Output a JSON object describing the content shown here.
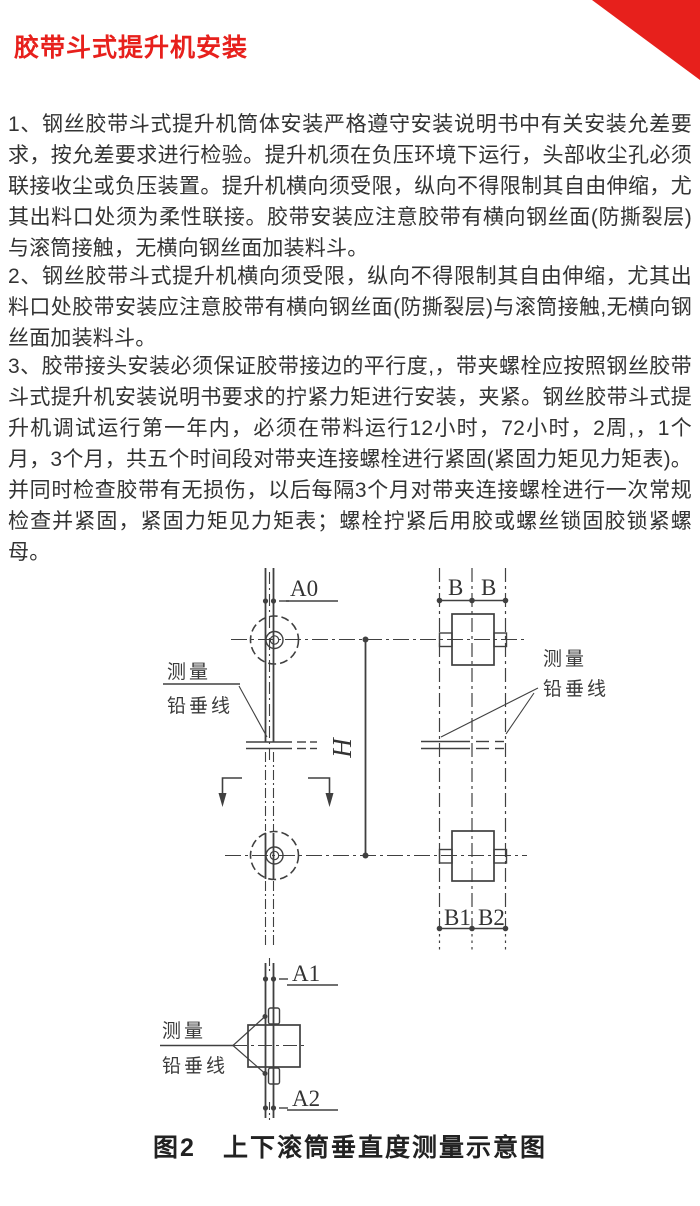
{
  "title": "胶带斗式提升机安装",
  "colors": {
    "accent": "#e7201c",
    "body_text": "#333333",
    "line": "#404040"
  },
  "paragraphs": {
    "p1": "1、钢丝胶带斗式提升机筒体安装严格遵守安装说明书中有关安装允差要求，按允差要求进行检验。提升机须在负压环境下运行，头部收尘孔必须联接收尘或负压装置。提升机横向须受限，纵向不得限制其自由伸缩，尤其出料口处须为柔性联接。胶带安装应注意胶带有横向钢丝面(防撕裂层)与滚筒接触，无横向钢丝面加装料斗。",
    "p2": "2、钢丝胶带斗式提升机横向须受限，纵向不得限制其自由伸缩，尤其出料口处胶带安装应注意胶带有横向钢丝面(防撕裂层)与滚筒接触,无横向钢丝面加装料斗。",
    "p3": "3、胶带接头安装必须保证胶带接边的平行度,，带夹螺栓应按照钢丝胶带斗式提升机安装说明书要求的拧紧力矩进行安装，夹紧。钢丝胶带斗式提升机调试运行第一年内，必须在带料运行12小时，72小时，2周,，1个月，3个月，共五个时间段对带夹连接螺栓进行紧固(紧固力矩见力矩表)。并同时检查胶带有无损伤，以后每隔3个月对带夹连接螺栓进行一次常规检查并紧固，紧固力矩见力矩表；螺栓拧紧后用胶或螺丝锁固胶锁紧螺母。"
  },
  "diagram": {
    "labels": {
      "a0": "A0",
      "a1": "A1",
      "a2": "A2",
      "b_left": "B",
      "b_right": "B",
      "b1": "B1",
      "b2": "B2",
      "h": "H",
      "measure_top_left_1": "测量",
      "measure_top_left_2": "铅垂线",
      "measure_top_right_1": "测量",
      "measure_top_right_2": "铅垂线",
      "measure_bottom_1": "测量",
      "measure_bottom_2": "铅垂线"
    },
    "caption": "图2　上下滚筒垂直度测量示意图"
  }
}
